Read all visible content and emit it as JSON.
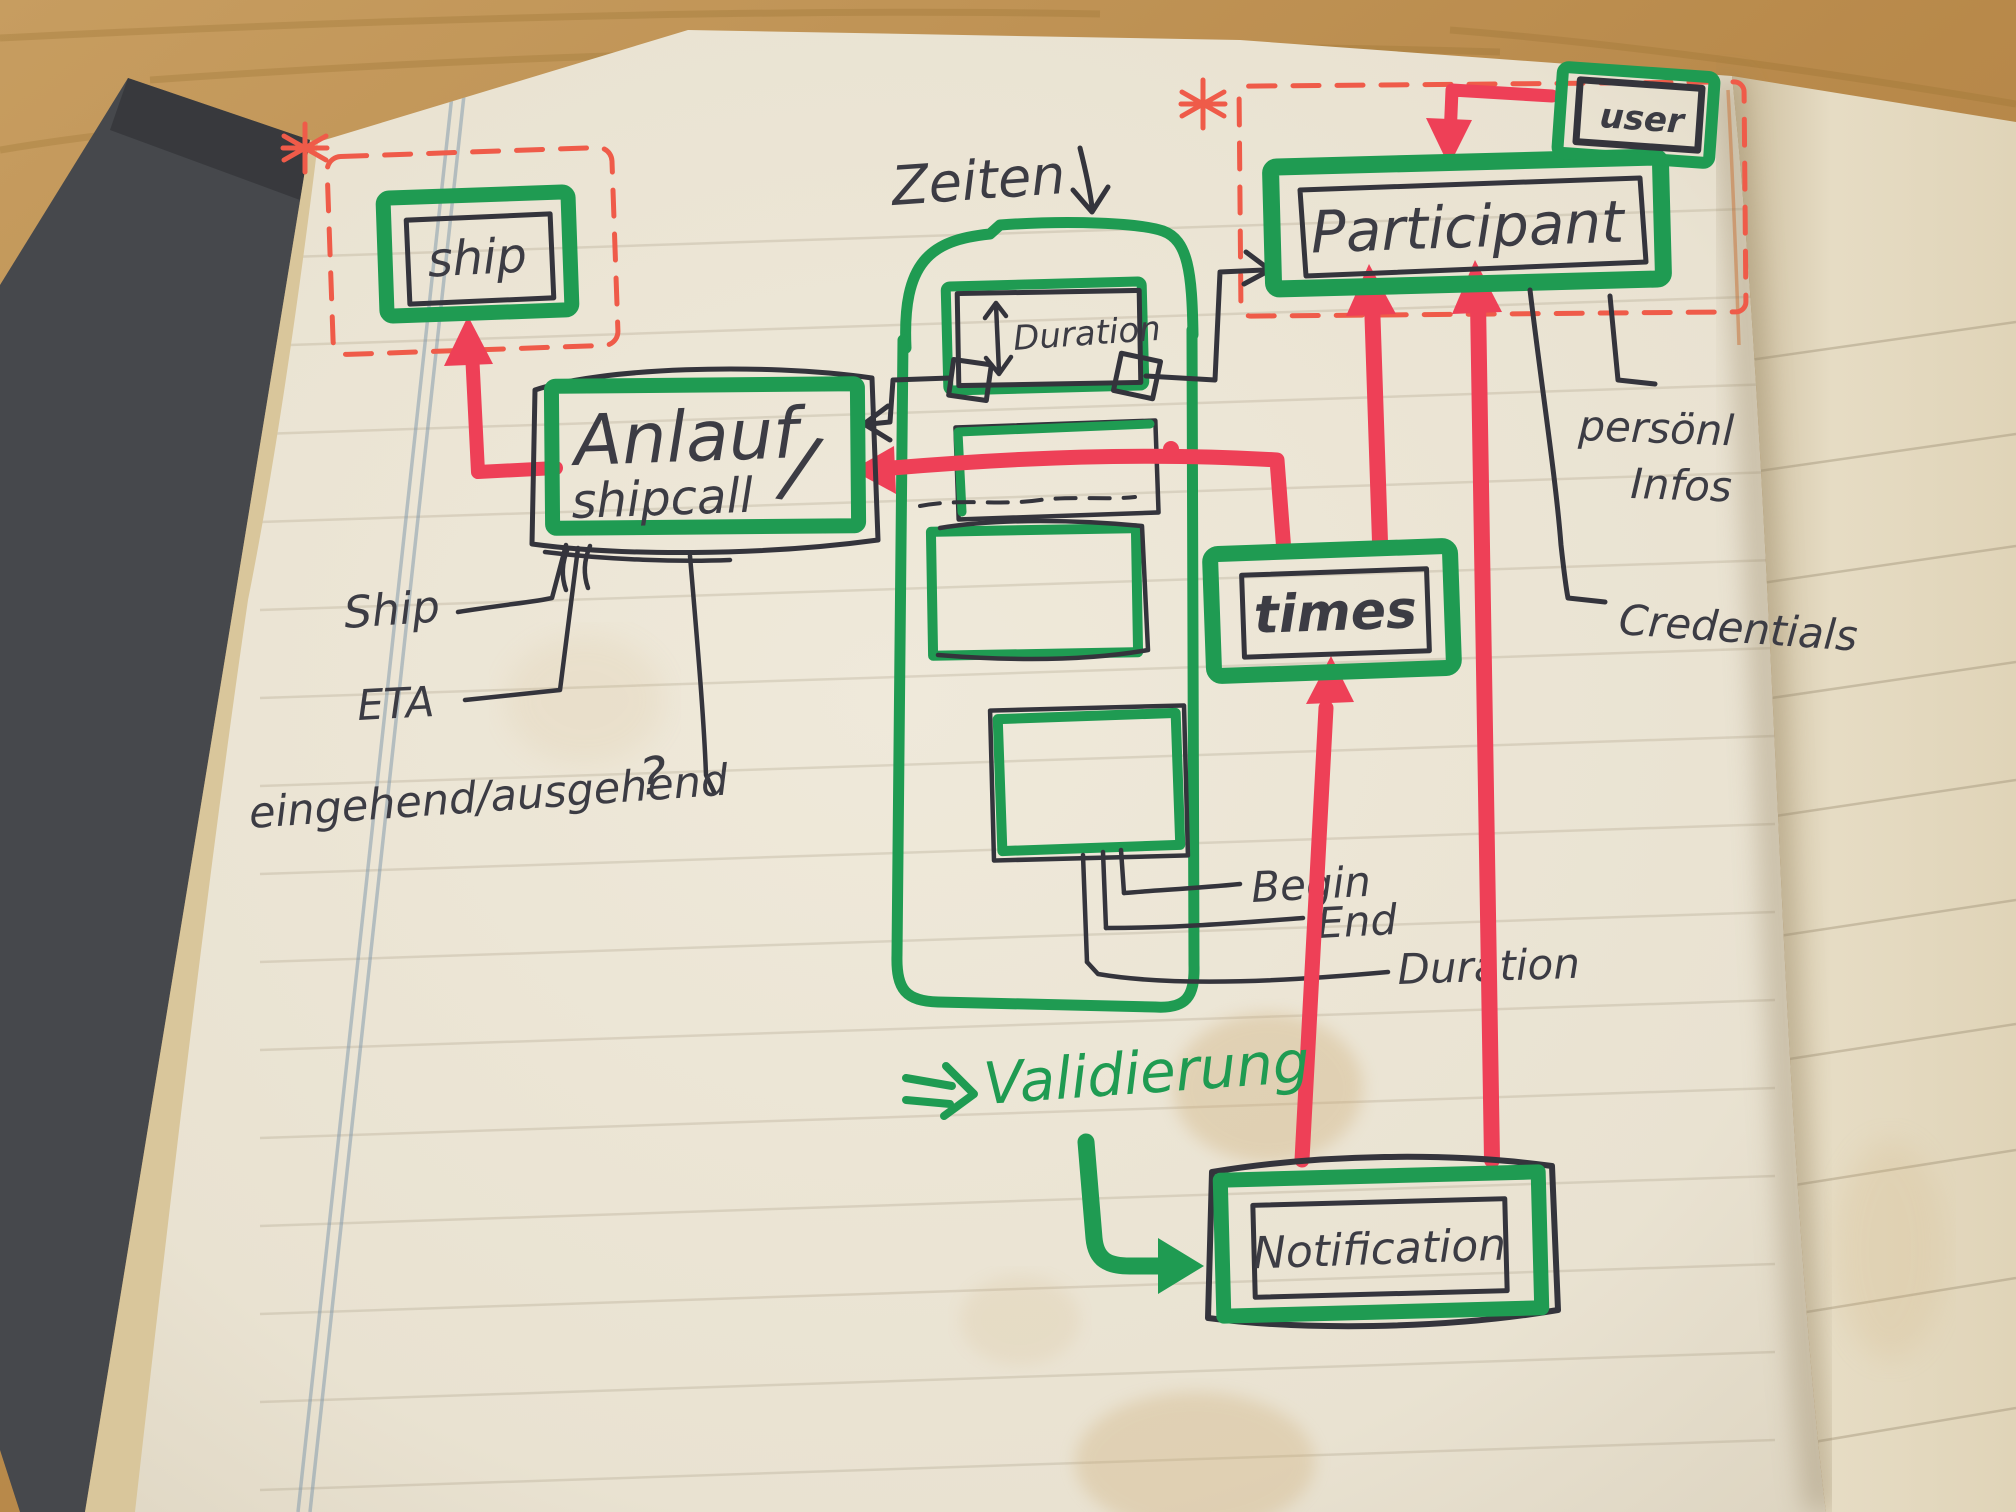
{
  "colors": {
    "green": "#1f9b52",
    "red": "#ee4057",
    "red-dash": "#ef5b49",
    "ink": "#34343c",
    "pen": "#3c3c44",
    "page": "#ece5d4",
    "page-edge": "#d9c69b",
    "page-right": "#e2d7bd",
    "wood": "#bb8d4d",
    "cover": "#46484c",
    "margin": "#7d97ab",
    "rule": "#8f8166",
    "stain": "#c9a469"
  },
  "entities": {
    "ship": {
      "label": "ship"
    },
    "shipcall": {
      "label": "Anlauf",
      "separator": "/",
      "sublabel": "shipcall"
    },
    "participant": {
      "label": "Participant"
    },
    "user": {
      "label": "user"
    },
    "duration": {
      "label": "Duration"
    },
    "times": {
      "label": "times"
    },
    "notification": {
      "label": "Notification"
    }
  },
  "annotations": {
    "zeiten": "Zeiten",
    "validierung": "Validierung"
  },
  "attributes": {
    "ship": "Ship",
    "eta": "ETA",
    "inout": "eingehend/ausgehend",
    "question": "?",
    "begin": "Begin",
    "end": "End",
    "duration": "Duration",
    "personal_line1": "persönl",
    "personal_line2": "Infos",
    "credentials": "Credentials"
  },
  "icons": {
    "asterisk": "*",
    "down_arrow": "↓",
    "implies_arrow": "⇒",
    "return_arrow": "↳"
  }
}
